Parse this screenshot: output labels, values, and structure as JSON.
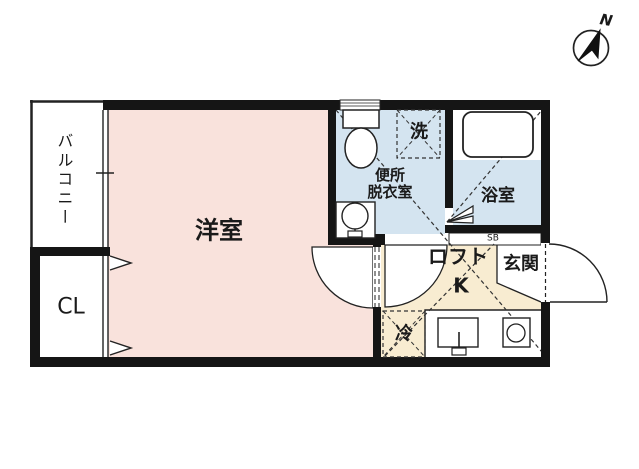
{
  "compass": {
    "north_label": "N"
  },
  "rooms": {
    "balcony": {
      "label": "バルコニー"
    },
    "western_room": {
      "label": "洋室"
    },
    "closet": {
      "label": "CL"
    },
    "toilet_dressing": {
      "label_line1": "便所",
      "label_line2": "脱衣室"
    },
    "washer": {
      "label": "洗"
    },
    "bathroom": {
      "label": "浴室"
    },
    "shoe_box": {
      "label": "SB"
    },
    "loft": {
      "label": "ロフト"
    },
    "kitchen": {
      "label": "K"
    },
    "entrance": {
      "label": "玄関"
    },
    "refrigerator": {
      "label": "冷"
    }
  },
  "colors": {
    "room_pink": "#f9e2dc",
    "wet_area_blue": "#d4e4f0",
    "kitchen_cream": "#f8ecd1",
    "wall_black": "#151515",
    "line_dark": "#333333"
  }
}
